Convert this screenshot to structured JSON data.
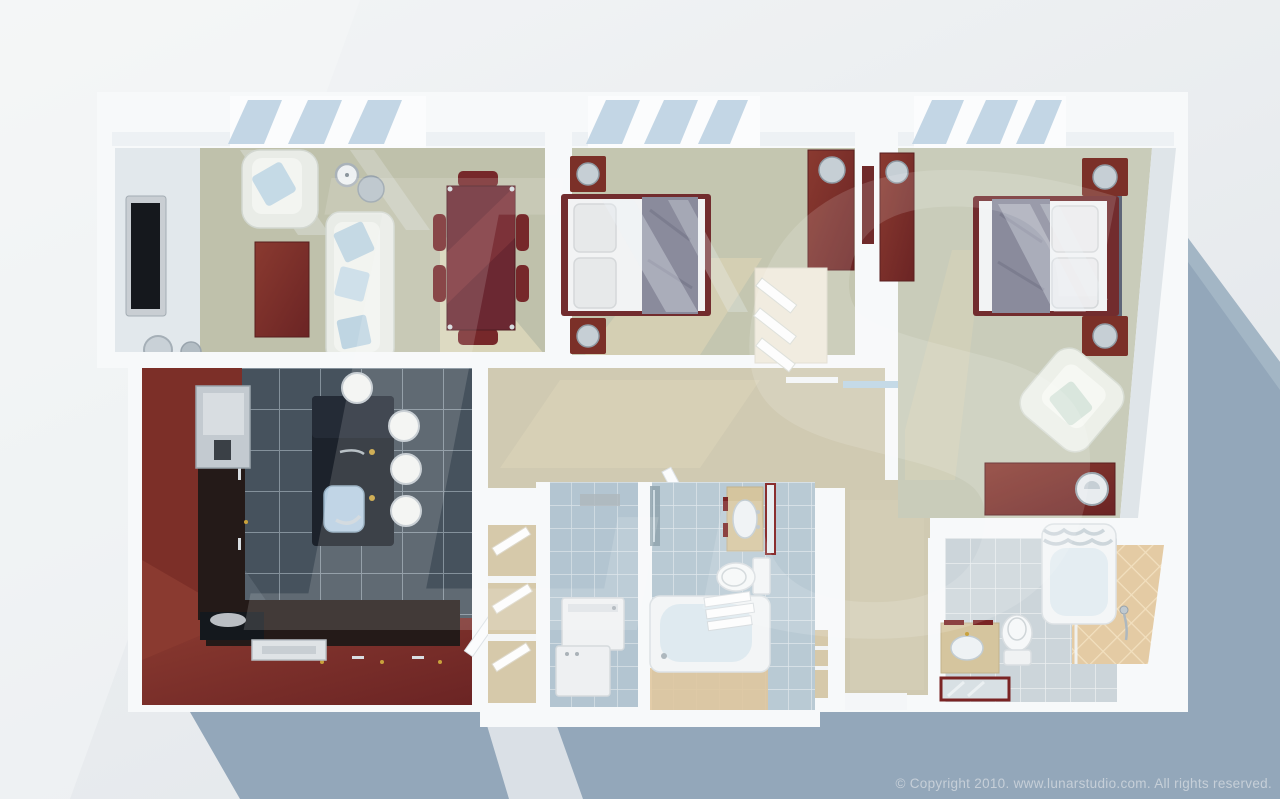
{
  "meta": {
    "description": "3D aerial rendering of a two-bedroom apartment floor plan",
    "render_style": "photoreal top-down dollhouse view with cast shadow"
  },
  "watermark": "LS",
  "footer": {
    "copyright": "© Copyright 2010. www.lunarstudio.com. All rights reserved."
  },
  "colors": {
    "background_top": "#f2f4f5",
    "background_bottom": "#e3e7ea",
    "shadow": "#93a7ba",
    "shadow_gap_light": "#dde3e8",
    "plan_white": "#f7f9fa",
    "wall_face_gray": "#e2e8ec",
    "carpet_living": "#bfc1ab",
    "carpet_bedroom": "#c4c6b0",
    "carpet_bedroom_right": "#c9ccba",
    "carpet_hall": "#d0cab2",
    "sun_patch": "#ded8bb",
    "kitchen_tile": "#46525d",
    "kitchen_grout": "#8f9ca6",
    "cabinet_maroon": "#7c2f28",
    "counter_dark": "#241a18",
    "island_dark": "#1c222b",
    "bath_tile": "#b9cad4",
    "laundry_tile": "#b3c5d1",
    "bath_gray_tile": "#ccd5da",
    "shower_tan": "#e4cba4",
    "closet_tan": "#d6c9aa",
    "furniture_maroon": "#722c2e",
    "fabric_white": "#e9ece7",
    "pillow_blue": "#c2d8e4",
    "bed_linen": "#f2f3f4",
    "bed_throw": "#8a8b9c",
    "headboard_navy": "#5f6678",
    "vanity_tan": "#d5c59e",
    "fixture_white": "#f3f5f6",
    "metal_silver": "#c0c9cf",
    "brass_gold": "#c9a23c",
    "window_glass": "#bcd2e2",
    "watermark_fill": "rgba(255,255,255,0.14)",
    "copyright_text": "#c6cfd8"
  },
  "scene": {
    "rooms": [
      {
        "name": "living-room",
        "furniture": [
          "wall-mounted-tv",
          "armchair",
          "sofa",
          "coffee-table",
          "dining-table",
          "dining-chairs",
          "wall-clock",
          "table-lamp",
          "floor-lamps",
          "window"
        ]
      },
      {
        "name": "kitchen",
        "furniture": [
          "l-shaped-cherry-cabinets",
          "refrigerator",
          "cooktop",
          "serving-tray",
          "island-with-sink",
          "bar-stools",
          "pantry-door"
        ]
      },
      {
        "name": "bedroom-middle",
        "furniture": [
          "double-bed",
          "nightstands",
          "table-lamps",
          "tall-dresser",
          "wall-art",
          "closet-shelves",
          "window"
        ]
      },
      {
        "name": "bedroom-right",
        "furniture": [
          "double-bed",
          "nightstands",
          "table-lamps",
          "tall-dresser",
          "low-dresser",
          "armchair",
          "window"
        ]
      },
      {
        "name": "hallway",
        "furniture": [
          "sliding-door-track",
          "doors",
          "entry-closet"
        ]
      },
      {
        "name": "laundry-room",
        "furniture": [
          "washer",
          "dryer"
        ]
      },
      {
        "name": "linen-closet",
        "furniture": [
          "shelves",
          "folded-linens"
        ]
      },
      {
        "name": "bathroom-middle",
        "furniture": [
          "bathtub",
          "towels",
          "toilet",
          "vanity-sink",
          "mirror",
          "shower-glass"
        ]
      },
      {
        "name": "bathroom-right",
        "furniture": [
          "bathtub-with-curtain",
          "toilet",
          "vanity-sink",
          "mirror",
          "shower-area",
          "hand-shower"
        ]
      }
    ]
  }
}
